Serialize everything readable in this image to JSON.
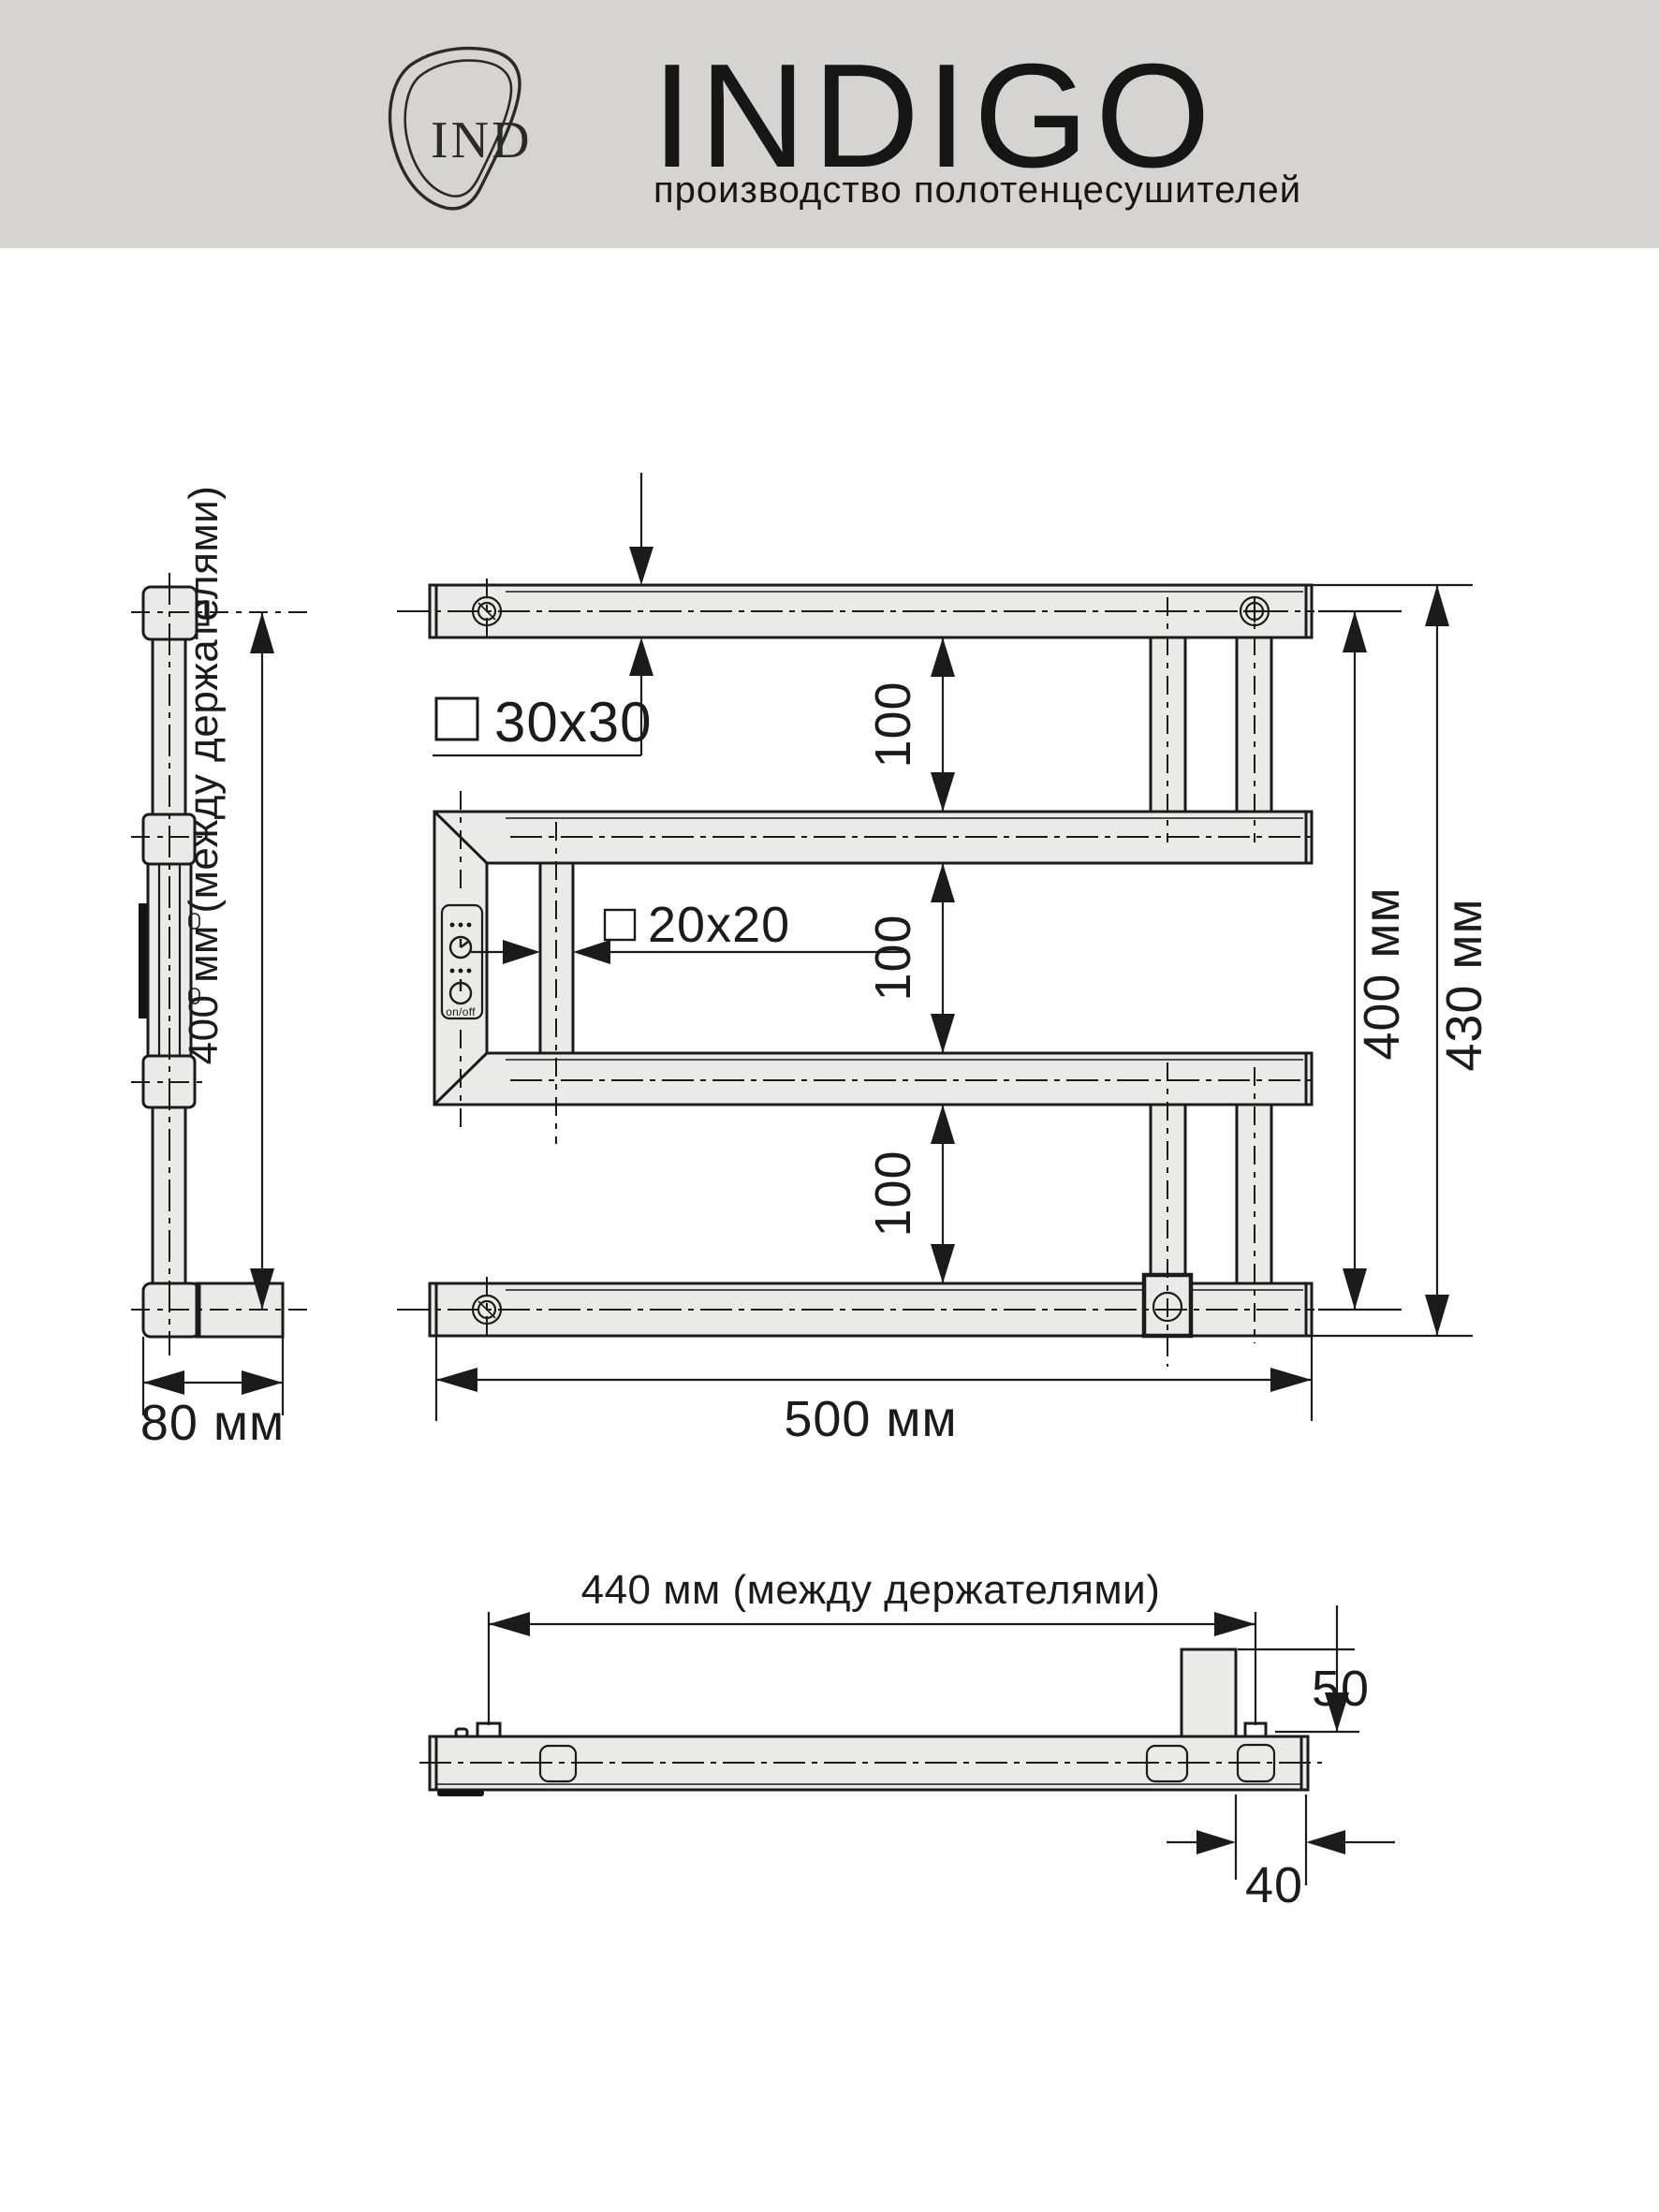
{
  "header": {
    "bg_color": "#d6d4d0",
    "brand": "INDIGO",
    "subtitle": "производство полотенцесушителей",
    "monogram": "IND"
  },
  "colors": {
    "line": "#1b1b1b",
    "part_fill": "#eaebe8",
    "panel_dark": "#141414",
    "paper": "#ffffff"
  },
  "front_view": {
    "profile_main_label": "30x30",
    "profile_rung_label": "20x20",
    "gap_labels": [
      "100",
      "100",
      "100"
    ],
    "height_axis_label": "400 мм",
    "height_overall_label": "430 мм",
    "width_label": "500 мм",
    "panel": {
      "on_off": "on/off"
    }
  },
  "side_view": {
    "holders_label": "400 мм (между держателями)",
    "depth_label": "80 мм"
  },
  "top_view": {
    "holders_label": "440 мм (между держателями)",
    "bracket_height_label": "50",
    "bracket_offset_label": "40"
  },
  "icons": {
    "logo": "brand-leaf-monogram-icon",
    "screw_plain": "screw-icon",
    "screw_cross": "cross-screw-icon",
    "timer": "timer-icon",
    "power": "power-icon",
    "square_30": "square-profile-icon",
    "square_20": "square-profile-icon"
  }
}
